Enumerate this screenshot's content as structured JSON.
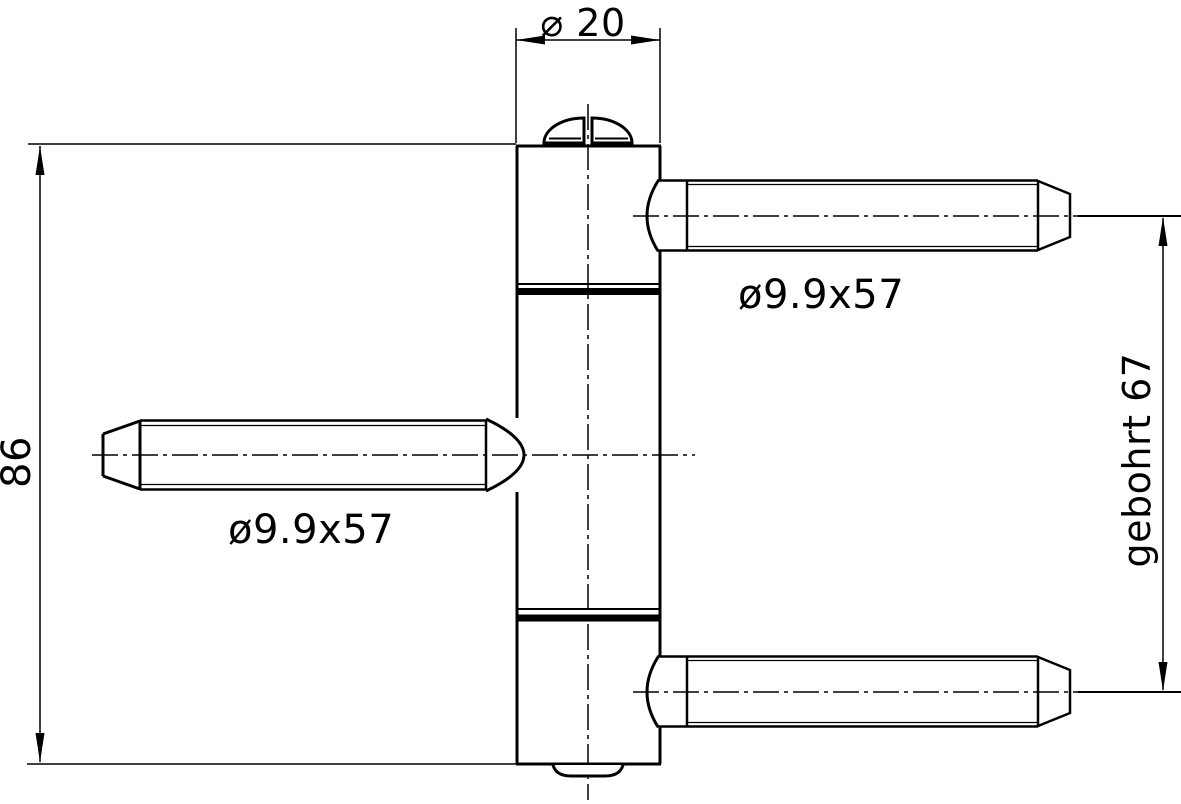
{
  "drawing": {
    "background_color": "#ffffff",
    "line_color": "#000000",
    "labels": {
      "top_diameter": "⌀ 20",
      "left_height": "86",
      "left_pin_size": "ø9.9x57",
      "right_pin_size": "ø9.9x57",
      "right_drilled": "gebohrt 67"
    }
  }
}
